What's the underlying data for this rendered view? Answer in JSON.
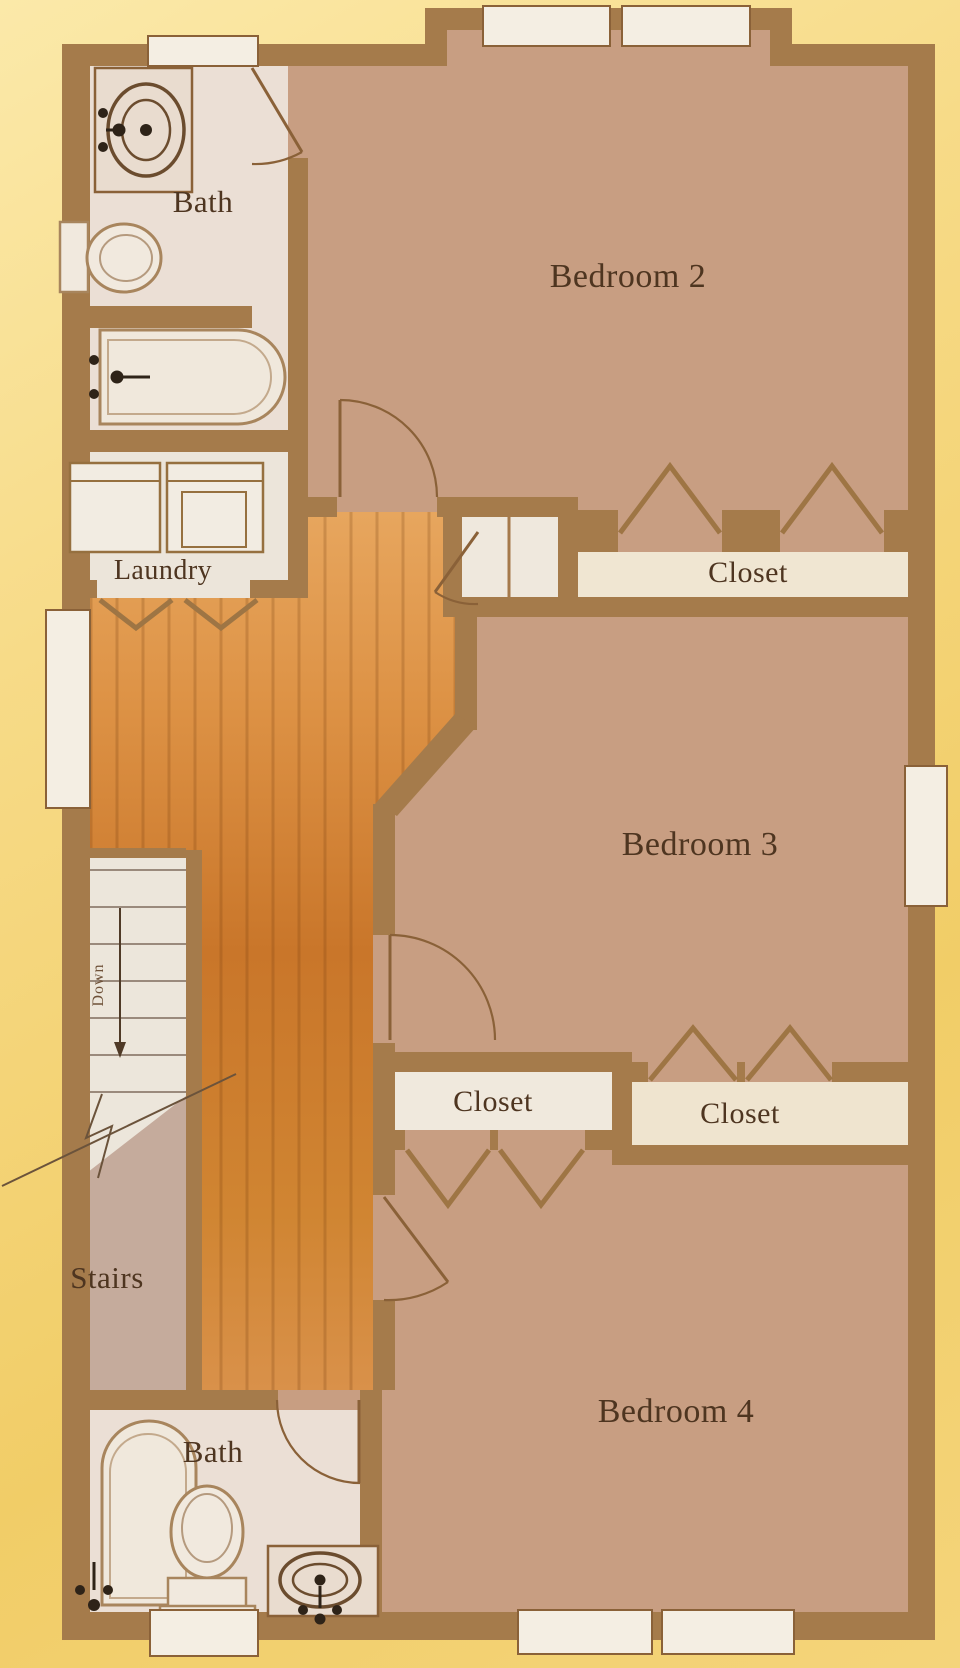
{
  "floor_plan": {
    "labels": {
      "bath_upper": "Bath",
      "bedroom_2": "Bedroom 2",
      "laundry": "Laundry",
      "closet_bedroom_2": "Closet",
      "bedroom_3": "Bedroom 3",
      "closet_bedroom_4": "Closet",
      "closet_bedroom_3": "Closet",
      "stairs": "Stairs",
      "down": "Down",
      "bath_lower": "Bath",
      "bedroom_4": "Bedroom 4"
    },
    "rooms": [
      {
        "id": "bath-upper",
        "label": "Bath"
      },
      {
        "id": "bedroom-2",
        "label": "Bedroom 2"
      },
      {
        "id": "laundry",
        "label": "Laundry"
      },
      {
        "id": "closet-bedroom-2",
        "label": "Closet"
      },
      {
        "id": "bedroom-3",
        "label": "Bedroom 3"
      },
      {
        "id": "closet-bedroom-4",
        "label": "Closet"
      },
      {
        "id": "closet-bedroom-3",
        "label": "Closet"
      },
      {
        "id": "stairs",
        "label": "Stairs",
        "direction": "Down"
      },
      {
        "id": "bath-lower",
        "label": "Bath"
      },
      {
        "id": "bedroom-4",
        "label": "Bedroom 4"
      }
    ],
    "colors": {
      "background": "#f5d67e",
      "walls": "#a57b4b",
      "bedroom_floor": "#c89e82",
      "hall_wood": "#cf8130",
      "bath_floor": "#ebdfd5",
      "closet_floor": "#f0e6d4",
      "stairs_landing": "#c5ab9c",
      "label_text": "#4e3520"
    }
  }
}
